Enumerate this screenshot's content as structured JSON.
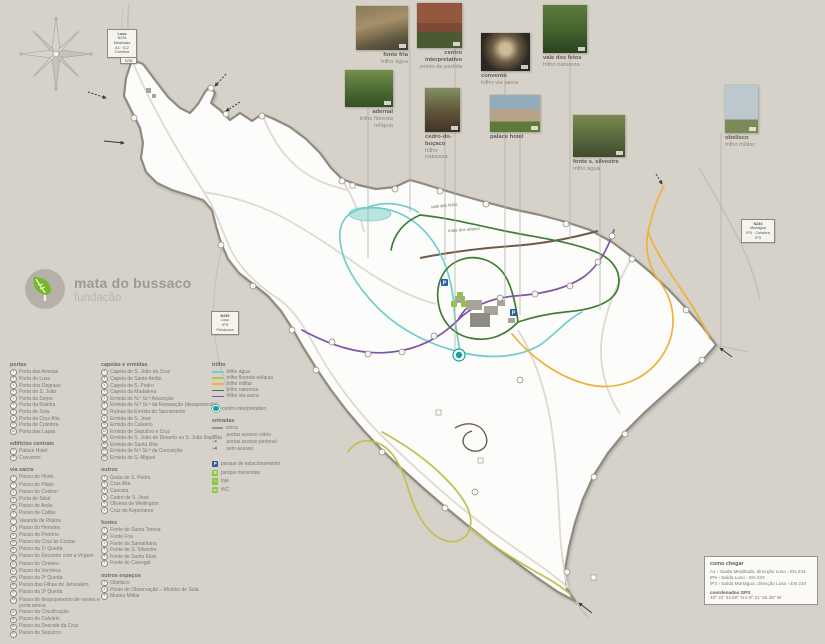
{
  "logo": {
    "title": "mata do bussaco",
    "subtitle": "fundação",
    "leaf_color": "#76b82a"
  },
  "photos": [
    {
      "name": "fonte fria",
      "sub": "trilho água"
    },
    {
      "name": "centro interpretativo",
      "sub": "ponto de partida"
    },
    {
      "name": "convento",
      "sub": "trilho via sacra"
    },
    {
      "name": "vale dos fetos",
      "sub": "trilho natureza"
    },
    {
      "name": "adernal",
      "sub": "trilho floresta relíquia"
    },
    {
      "name": "cedro-do-buçaco",
      "sub": "trilho natureza"
    },
    {
      "name": "palace hotel",
      "sub": ""
    },
    {
      "name": "fonte s. silvestre",
      "sub": "trilho água"
    },
    {
      "name": "obelisco",
      "sub": "trilho militar"
    }
  ],
  "signs": {
    "north": [
      "Luso",
      "N234",
      "Mealhada",
      "A1 · IC2",
      "Coimbra"
    ],
    "north_tag": "N235",
    "west": [
      "N235",
      "Luso",
      "IP3",
      "Penacova"
    ],
    "east": [
      "N234",
      "Mortágua",
      "IP3 · Coimbra",
      "IP3"
    ]
  },
  "map_labels": [
    "vale dos fetos",
    "mata dos abetos"
  ],
  "legend": {
    "portas": {
      "header": "portas",
      "items": [
        "Porta das Ameias",
        "Porta do Luso",
        "Porta dos Degraus",
        "Porta de S. João",
        "Porta da Serpe",
        "Porta da Rainha",
        "Porta de Sula",
        "Porta da Cruz Alta",
        "Porta de Coimbra",
        "Porta das Lapas"
      ]
    },
    "edificios": {
      "header": "edifícios centrais",
      "items": [
        "Palace Hotel",
        "Convento"
      ]
    },
    "via_sacra": {
      "header": "via sacra",
      "items": [
        "Passo do Horto",
        "Passo do Pilato",
        "Passo do Cedron",
        "Porta de Siloé",
        "Passo de Anás",
        "Passo de Caifás",
        "Varanda de Pilatos",
        "Passo do Herodes",
        "Passo do Pretório",
        "Passo da Cruz às Costas",
        "Passo da 1ª Queda",
        "Passo do Encontro com a Virgem",
        "Passo do Cireneu",
        "Passo da Verónica",
        "Passo da 2ª Queda",
        "Passo das Filhas de Jerusalém",
        "Passo da 3ª Queda",
        "Passo do despojamento de vestes e porta anexa",
        "Passo da Crucificação",
        "Passo do Calvário",
        "Passo da Descida da Cruz",
        "Passo do Sepulcro"
      ]
    },
    "capelas": {
      "header": "capelas e ermidas",
      "items": [
        "Capela de S. João da Cruz",
        "Capela de Santo Antão",
        "Capela de S. Pedro",
        "Capela da Madalena",
        "Ermida de N.ª Sr.ª Assunção",
        "Ermida de N.ª Sr.ª da Reparação (desaparecida)",
        "Ruínas da Ermida do Sacramento",
        "Ermida de S. José",
        "Ermida do Calvário",
        "Ermida de Sepulcro e Cruz",
        "Ermida de S. João de Deserto ou S. João Baptista",
        "Ermida de Santa Rita",
        "Ermida de N.ª Sr.ª da Conceição",
        "Ermida de S. Miguel"
      ]
    },
    "outros": {
      "header": "outros",
      "items": [
        "Gruta de S. Pedro",
        "Cruz Alta",
        "Cascata",
        "Cedro de S. José",
        "Oliveira de Wellington",
        "Cruz de Koperlares"
      ]
    },
    "fontes": {
      "header": "fontes",
      "items": [
        "Fonte de Santa Teresa",
        "Fonte Fria",
        "Fonte da Samaritana",
        "Fonte de S. Silvestre",
        "Fonte de Santo Elias",
        "Fonte do Carregal"
      ]
    },
    "espacos": {
      "header": "outros espaços",
      "items": [
        "Obelisco",
        "Posto de Observação – Moinho de Sula",
        "Museu Militar"
      ]
    },
    "trilhos": {
      "header": "trilho",
      "items": [
        {
          "label": "trilho água",
          "color": "#6fcfcb"
        },
        {
          "label": "trilho floresta relíquia",
          "color": "#bcc24e"
        },
        {
          "label": "trilho militar",
          "color": "#efb13a"
        },
        {
          "label": "trilho natureza",
          "color": "#3f7d37"
        },
        {
          "label": "trilho via sacra",
          "color": "#7d55a8"
        }
      ]
    },
    "centro_label": "centro interpretativo",
    "entradas": {
      "header": "entradas",
      "items": [
        {
          "label": "cerca",
          "type": "line"
        },
        {
          "label": "portas acesso viário",
          "type": "arrow-solid"
        },
        {
          "label": "portas acesso pedonal",
          "type": "arrow-dashed"
        },
        {
          "label": "sem acesso",
          "type": "no-access"
        }
      ]
    },
    "amenities": [
      {
        "label": "parque de estacionamento",
        "type": "parking",
        "color": "#2e5c9e"
      },
      {
        "label": "parque merendas",
        "type": "picnic",
        "color": "#8dc63f"
      },
      {
        "label": "loja",
        "type": "shop",
        "color": "#8dc63f"
      },
      {
        "label": "WC",
        "type": "wc",
        "color": "#8dc63f"
      }
    ]
  },
  "como_chegar": {
    "title": "como chegar",
    "routes": [
      "A1 › Saída Mealhada, direcção Luso › EN 234",
      "IP5 › Saída Luso › EN 233",
      "IP3 › Saída Mortágua, direcção Luso › EN 234"
    ],
    "gps_label": "coordenadas GPS",
    "gps_value": "40º 22' 34.50'' N e 8º 21' 56.48'' W"
  }
}
